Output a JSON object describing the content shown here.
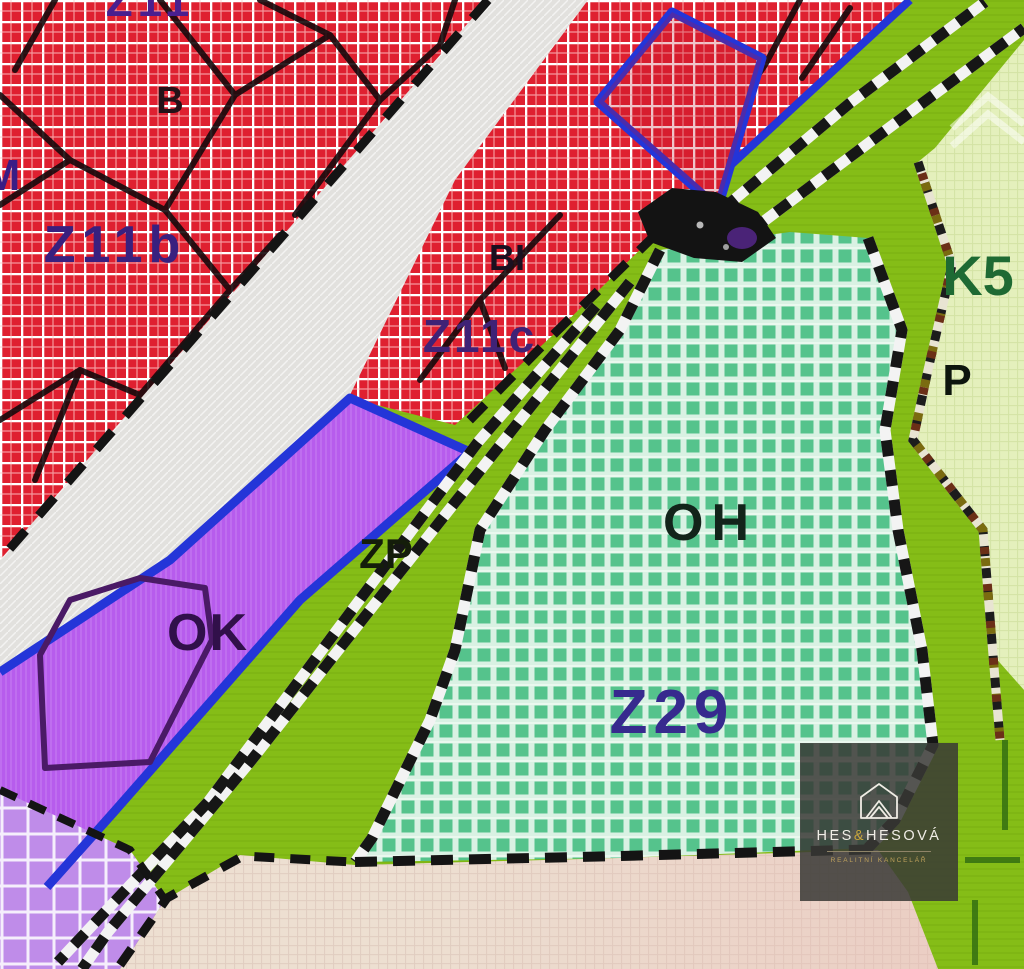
{
  "map": {
    "zones": {
      "labels": [
        {
          "id": "b",
          "text": "B"
        },
        {
          "id": "z11b",
          "text": "Z11b"
        },
        {
          "id": "bi",
          "text": "BI"
        },
        {
          "id": "z11c",
          "text": "Z11c"
        },
        {
          "id": "zp",
          "text": "ZP"
        },
        {
          "id": "ok",
          "text": "OK"
        },
        {
          "id": "oh",
          "text": "OH"
        },
        {
          "id": "z29",
          "text": "Z29"
        },
        {
          "id": "k5",
          "text": "K5"
        },
        {
          "id": "p",
          "text": "P"
        }
      ],
      "edge_fragments": [
        {
          "text": "Z11"
        },
        {
          "text": "M"
        }
      ]
    },
    "colors": {
      "residential_red": "#df2030",
      "road_gray": "#e2e1de",
      "commercial_purple": "#b75ced",
      "greenery_strip": "#85bd17",
      "reserve_teal": "#55c38c",
      "orchard_pale_green": "#e4f0bc",
      "agriculture_beige": "#eddfd1",
      "boundary_blue": "#2435d8",
      "label_indigo": "#39207f",
      "label_dark_green": "#1e6a33"
    },
    "watermark": {
      "brand_start": "HES",
      "brand_amp": "&",
      "brand_end": "HESOVÁ",
      "subtitle": "REALITNÍ KANCELÁŘ"
    }
  }
}
